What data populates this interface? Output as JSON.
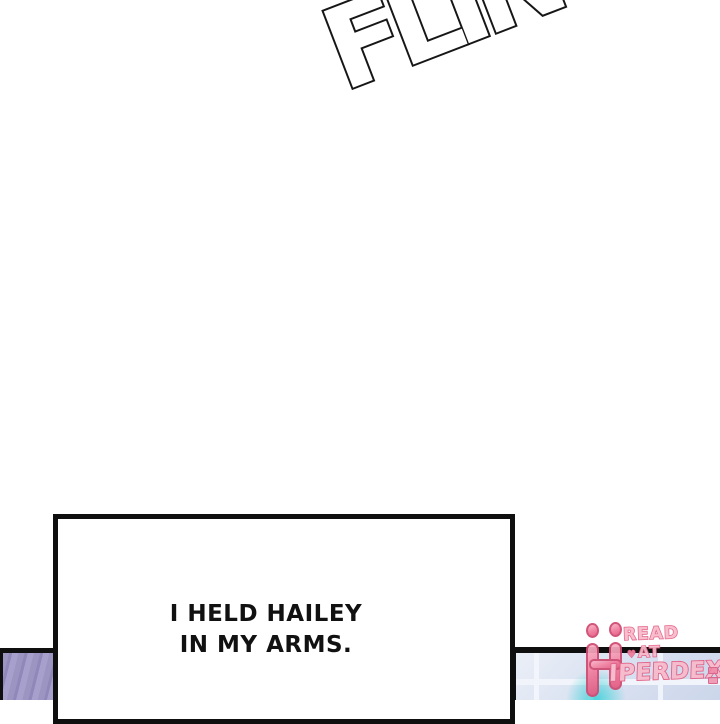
{
  "sfx": {
    "text": "FLINCH"
  },
  "caption": {
    "lines": [
      "I HELD HAILEY",
      "IN MY ARMS."
    ]
  },
  "watermark": {
    "brand_initial": "H",
    "read_label": "READ",
    "at_label": "AT",
    "heart": "♥",
    "brand_rest": "IPERDEX"
  },
  "colors": {
    "ink_black": "#0f0f0f",
    "panel_purple": "#9c95c2",
    "tile_blue": "#dae2f1",
    "glow_cyan": "#3fd2da",
    "logo_pink": "#f07a9c",
    "logo_outline": "#cf4a71"
  }
}
